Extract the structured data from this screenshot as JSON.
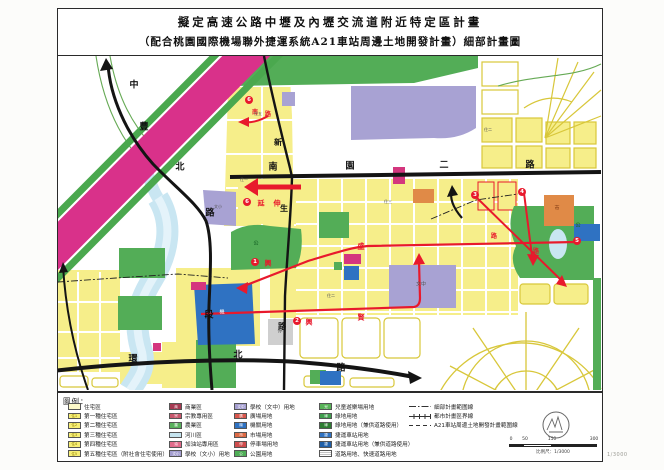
{
  "title": {
    "line1": "擬定高速公路中壢及內壢交流道附近特定區計畫",
    "line2": "（配合桃園國際機場聯外捷運系統A21車站周邊土地開發計畫）細部計畫圖"
  },
  "colors": {
    "highway": "#d9318a",
    "highway_edge": "#4aa84e",
    "road_black": "#141414",
    "road_red": "#e8192c",
    "residential_yellow": "#f6ee8a",
    "residential_pale": "#fdf9c9",
    "school_purple": "#a8a2d3",
    "government_blue": "#2f72c2",
    "park_green": "#53ad57",
    "river_blue": "#c9e6f2",
    "commercial_magenta": "#d4367e",
    "market_orange": "#e08a47",
    "parking_gray": "#cfcfcf"
  },
  "map": {
    "labels": [
      {
        "t": "中",
        "x": 76,
        "y": 30,
        "k": "k",
        "s": 9
      },
      {
        "t": "豐",
        "x": 86,
        "y": 72,
        "k": "k",
        "s": 9
      },
      {
        "t": "北",
        "x": 122,
        "y": 112,
        "k": "k",
        "s": 9
      },
      {
        "t": "路",
        "x": 152,
        "y": 158,
        "k": "k",
        "s": 9
      },
      {
        "t": "段",
        "x": 151,
        "y": 260,
        "k": "k",
        "s": 9
      },
      {
        "t": "新",
        "x": 220,
        "y": 86,
        "k": "k",
        "s": 8
      },
      {
        "t": "生",
        "x": 226,
        "y": 152,
        "k": "k",
        "s": 8
      },
      {
        "t": "路",
        "x": 224,
        "y": 270,
        "k": "k",
        "s": 8
      },
      {
        "t": "南",
        "x": 215,
        "y": 112,
        "k": "k",
        "s": 9
      },
      {
        "t": "園",
        "x": 292,
        "y": 111,
        "k": "k",
        "s": 9
      },
      {
        "t": "二",
        "x": 386,
        "y": 110,
        "k": "k",
        "s": 9
      },
      {
        "t": "路",
        "x": 472,
        "y": 110,
        "k": "k",
        "s": 9
      },
      {
        "t": "環",
        "x": 75,
        "y": 304,
        "k": "k",
        "s": 9
      },
      {
        "t": "北",
        "x": 180,
        "y": 300,
        "k": "k",
        "s": 9
      },
      {
        "t": "路",
        "x": 283,
        "y": 313,
        "k": "k",
        "s": 9
      },
      {
        "t": "興",
        "x": 210,
        "y": 207,
        "k": "r",
        "s": 7
      },
      {
        "t": "盛",
        "x": 303,
        "y": 190,
        "k": "r",
        "s": 7
      },
      {
        "t": "興",
        "x": 251,
        "y": 266,
        "k": "r",
        "s": 7
      },
      {
        "t": "賢",
        "x": 303,
        "y": 261,
        "k": "r",
        "s": 7
      },
      {
        "t": "延",
        "x": 203,
        "y": 147,
        "k": "r",
        "s": 7
      },
      {
        "t": "伸",
        "x": 219,
        "y": 147,
        "k": "r",
        "s": 7
      },
      {
        "t": "南",
        "x": 197,
        "y": 57,
        "k": "r",
        "s": 6
      },
      {
        "t": "路",
        "x": 210,
        "y": 59,
        "k": "r",
        "s": 6
      },
      {
        "t": "路",
        "x": 436,
        "y": 181,
        "k": "r",
        "s": 6
      },
      {
        "t": "路",
        "x": 478,
        "y": 196,
        "k": "r",
        "s": 6
      },
      {
        "t": "住五",
        "x": 200,
        "y": 58,
        "k": "z",
        "s": 4
      },
      {
        "t": "住二",
        "x": 430,
        "y": 74,
        "k": "z",
        "s": 4
      },
      {
        "t": "住二",
        "x": 273,
        "y": 240,
        "k": "z",
        "s": 4
      },
      {
        "t": "住三",
        "x": 330,
        "y": 146,
        "k": "z",
        "s": 4
      },
      {
        "t": "住一",
        "x": 186,
        "y": 124,
        "k": "z",
        "s": 4
      },
      {
        "t": "文中",
        "x": 363,
        "y": 229,
        "k": "z",
        "s": 5
      },
      {
        "t": "文小",
        "x": 160,
        "y": 151,
        "k": "z",
        "s": 4
      },
      {
        "t": "機",
        "x": 164,
        "y": 257,
        "k": "w",
        "s": 5
      },
      {
        "t": "公",
        "x": 198,
        "y": 188,
        "k": "g",
        "s": 5
      },
      {
        "t": "公",
        "x": 520,
        "y": 170,
        "k": "g",
        "s": 5
      },
      {
        "t": "停",
        "x": 222,
        "y": 276,
        "k": "z",
        "s": 5
      },
      {
        "t": "市",
        "x": 499,
        "y": 153,
        "k": "o",
        "s": 5
      }
    ],
    "badges": [
      {
        "n": "1",
        "x": 197,
        "y": 206
      },
      {
        "n": "2",
        "x": 239,
        "y": 265
      },
      {
        "n": "3",
        "x": 417,
        "y": 139
      },
      {
        "n": "4",
        "x": 464,
        "y": 136
      },
      {
        "n": "5",
        "x": 519,
        "y": 185
      },
      {
        "n": "6",
        "x": 191,
        "y": 44
      },
      {
        "n": "6",
        "x": 189,
        "y": 146
      }
    ]
  },
  "legend": {
    "heading": "圖例：",
    "columns": [
      {
        "items": [
          {
            "type": "zone",
            "color": "#fdf9c9",
            "text": "",
            "text_color": "#8a7a00",
            "label": "住宅區"
          },
          {
            "type": "zone",
            "color": "#f7ef75",
            "text": "住1",
            "text_color": "#8a7a00",
            "label": "第一種住宅區"
          },
          {
            "type": "zone",
            "color": "#f7ef75",
            "text": "住2",
            "text_color": "#8a7a00",
            "label": "第二種住宅區"
          },
          {
            "type": "zone",
            "color": "#f7ef75",
            "text": "住3",
            "text_color": "#8a7a00",
            "label": "第三種住宅區"
          },
          {
            "type": "zone",
            "color": "#f7ef75",
            "text": "住4",
            "text_color": "#8a7a00",
            "label": "第四種住宅區"
          },
          {
            "type": "zone",
            "color": "#f7ef75",
            "text": "住5",
            "text_color": "#8a7a00",
            "label": "第五種住宅區（附社會住宅使用）"
          }
        ]
      },
      {
        "items": [
          {
            "type": "zone",
            "color": "#a63a52",
            "text": "商",
            "text_color": "#fff",
            "label": "商業區"
          },
          {
            "type": "zone",
            "color": "#c8566b",
            "text": "宗",
            "text_color": "#fff",
            "label": "宗教專用區"
          },
          {
            "type": "zone",
            "color": "#58b05c",
            "text": "農",
            "text_color": "#fff",
            "label": "農業區"
          },
          {
            "type": "zone",
            "color": "#c5e4ef",
            "text": "",
            "text_color": "#336",
            "label": "河川區"
          },
          {
            "type": "zone",
            "color": "#e06a8a",
            "text": "油",
            "text_color": "#fff",
            "label": "加油站專用區"
          },
          {
            "type": "zone",
            "color": "#a49ed0",
            "text": "文小",
            "text_color": "#fff",
            "label": "學校（文小）用地"
          }
        ]
      },
      {
        "items": [
          {
            "type": "zone",
            "color": "#a49ed0",
            "text": "文中",
            "text_color": "#fff",
            "label": "學校（文中）用地"
          },
          {
            "type": "zone",
            "color": "#d8574d",
            "text": "廣",
            "text_color": "#fff",
            "label": "廣場用地"
          },
          {
            "type": "zone",
            "color": "#2f72c2",
            "text": "機",
            "text_color": "#fff",
            "label": "機關用地"
          },
          {
            "type": "zone",
            "color": "#dd6a45",
            "text": "市",
            "text_color": "#fff",
            "label": "市場用地"
          },
          {
            "type": "zone",
            "color": "#cf4d4d",
            "text": "停",
            "text_color": "#fff",
            "label": "停車場用地"
          },
          {
            "type": "zone",
            "color": "#4fae57",
            "text": "公",
            "text_color": "#fff",
            "label": "公園用地"
          }
        ]
      },
      {
        "items": [
          {
            "type": "zone",
            "color": "#57b257",
            "text": "兒",
            "text_color": "#fff",
            "label": "兒童遊樂場用地"
          },
          {
            "type": "zone",
            "color": "#3f9e4d",
            "text": "綠",
            "text_color": "#fff",
            "label": "綠地用地"
          },
          {
            "type": "zone",
            "color": "#2e7d32",
            "text": "綠",
            "text_color": "#fff",
            "label": "綠地用地（兼供道路使用）"
          },
          {
            "type": "zone",
            "color": "#2f72c2",
            "text": "捷",
            "text_color": "#fff",
            "label": "捷運車站用地"
          },
          {
            "type": "zone",
            "color": "#1f5fa8",
            "text": "捷",
            "text_color": "#fff",
            "label": "捷運車站用地（兼供道路使用）"
          },
          {
            "type": "hatch",
            "label": "道路用地、快速道路用地"
          }
        ]
      },
      {
        "items": [
          {
            "type": "line",
            "style": "dashdot",
            "label": "細部計畫範圍線"
          },
          {
            "type": "line",
            "style": "cross",
            "label": "都市計畫區界線"
          },
          {
            "type": "line",
            "style": "dash",
            "label": "A21車站周邊土地開發計畫範圍線"
          }
        ]
      }
    ]
  },
  "scale": {
    "ticks": [
      "0",
      "50",
      "150",
      "300"
    ],
    "caption": "比例尺：1/3000"
  },
  "corner_note": "1/3000"
}
